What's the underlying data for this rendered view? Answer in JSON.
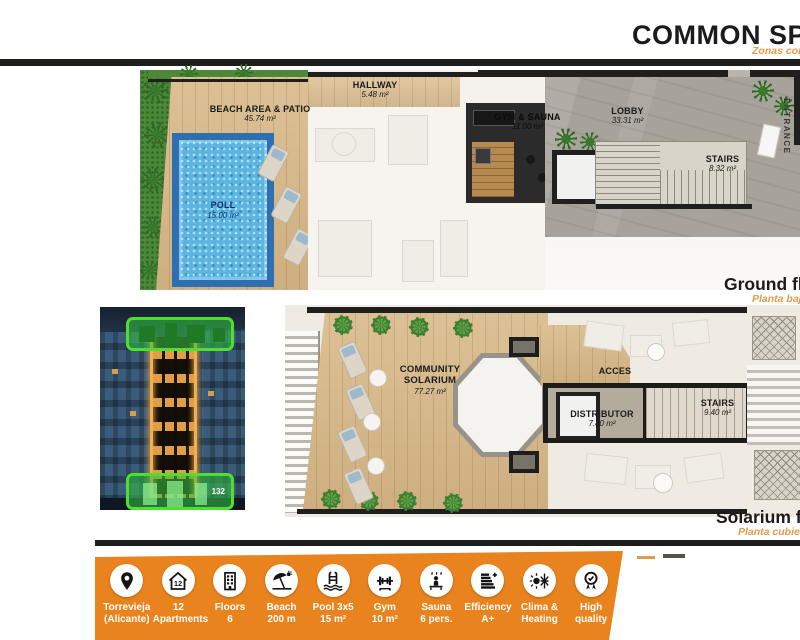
{
  "header": {
    "title": "COMMON SPACES",
    "subtitle": "Zonas comunes"
  },
  "ground_floor": {
    "caption": "Ground floor",
    "caption_sub": "Planta baja",
    "rooms": [
      {
        "name": "BEACH AREA & PATIO",
        "area": "45.74 m²"
      },
      {
        "name": "POLL",
        "area": "15.00 m²"
      },
      {
        "name": "HALLWAY",
        "area": "5.48 m²"
      },
      {
        "name": "GYM & SAUNA",
        "area": "11.00 m²"
      },
      {
        "name": "LOBBY",
        "area": "33.31 m²"
      },
      {
        "name": "STAIRS",
        "area": "8.32 m²"
      },
      {
        "name": "ENTRANCE",
        "area": ""
      }
    ]
  },
  "solarium_floor": {
    "caption": "Solarium floor",
    "caption_sub": "Planta cubierta",
    "rooms": [
      {
        "name": "COMMUNITY SOLARIUM",
        "area": "77.27 m²"
      },
      {
        "name": "ACCES",
        "area": ""
      },
      {
        "name": "DISTRIBUTOR",
        "area": "7.80 m²"
      },
      {
        "name": "STAIRS",
        "area": "9.40 m²"
      }
    ]
  },
  "building_photo": {
    "badge": "132"
  },
  "features": [
    {
      "icon": "location-icon",
      "line1": "Torrevieja",
      "line2": "(Alicante)"
    },
    {
      "icon": "apartments-icon",
      "line1": "12",
      "line2": "Apartments",
      "badge": "12"
    },
    {
      "icon": "floors-icon",
      "line1": "Floors",
      "line2": "6"
    },
    {
      "icon": "beach-icon",
      "line1": "Beach",
      "line2": "200 m"
    },
    {
      "icon": "pool-icon",
      "line1": "Pool 3x5",
      "line2": "15 m²"
    },
    {
      "icon": "gym-icon",
      "line1": "Gym",
      "line2": "10 m²"
    },
    {
      "icon": "sauna-icon",
      "line1": "Sauna",
      "line2": "6 pers."
    },
    {
      "icon": "efficiency-icon",
      "line1": "Efficiency",
      "line2": "A+"
    },
    {
      "icon": "clima-icon",
      "line1": "Clima &",
      "line2": "Heating"
    },
    {
      "icon": "quality-icon",
      "line1": "High",
      "line2": "quality"
    }
  ],
  "colors": {
    "accent_orange": "#E8831D",
    "subtitle_orange": "#E39A4C",
    "highlight_green": "#4FE02F",
    "pool_blue": "#5AB5E0",
    "wood": "#D8B887",
    "line_black": "#1D1D1B"
  }
}
